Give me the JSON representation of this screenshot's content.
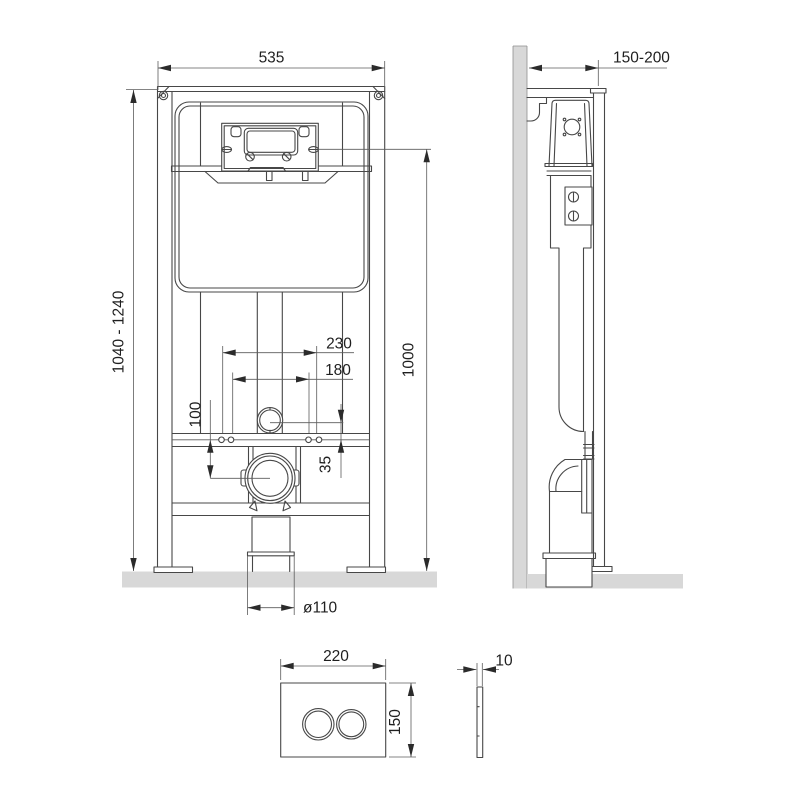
{
  "dims": {
    "frame_width": "535",
    "height_range": "1040 - 1240",
    "flush_height": "1000",
    "depth_range": "150-200",
    "spacing_outer": "230",
    "spacing_inner": "180",
    "outlet_drop": "100",
    "rod_offset": "35",
    "drain_diameter": "ø110",
    "plate_width": "220",
    "plate_height": "150",
    "plate_depth": "10"
  },
  "colors": {
    "line": "#474747",
    "text": "#1f1f1f",
    "surface": "#d8d8d8",
    "background": "#ffffff"
  }
}
